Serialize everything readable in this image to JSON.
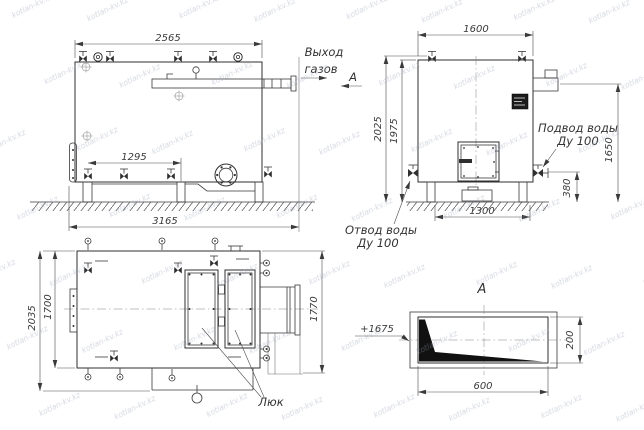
{
  "watermark": "kotlan-kv.kz",
  "front_view": {
    "dim_top_width": "2565",
    "dim_valve_span": "1295",
    "dim_total_length": "3165",
    "label_gas_line1": "Выход",
    "label_gas_line2": "газов",
    "label_section_arrow": "А"
  },
  "side_view": {
    "dim_top_width": "1600",
    "dim_height_overall": "2025",
    "dim_height_body": "1975",
    "dim_outlet_height": "1650",
    "dim_pipe_height": "380",
    "dim_base_span": "1300",
    "label_supply_line1": "Подвод воды",
    "label_supply_line2": "Ду 100",
    "label_return_line1": "Отвод воды",
    "label_return_line2": "Ду 100"
  },
  "plan_view": {
    "dim_width_overall": "2035",
    "dim_width_body": "1700",
    "dim_width_rear": "1770",
    "label_hatch": "Люк"
  },
  "section_view": {
    "title": "А",
    "dim_height": "200",
    "dim_width": "600",
    "label_elevation": "+1675"
  }
}
